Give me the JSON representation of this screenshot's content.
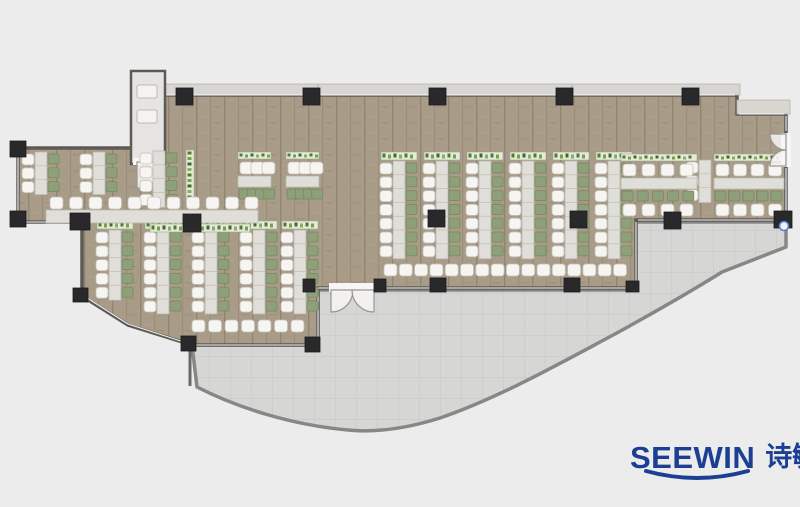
{
  "logo": {
    "brand": "SEEWIN",
    "cn": "诗敏",
    "color": "#1b3f92"
  },
  "palette": {
    "page_bg": "#ececec",
    "floor": "#a89b87",
    "floor_stroke": "#5d5a56",
    "terrace": "#d6d6d4",
    "terrace_stroke": "#878785",
    "band": "#d8d6d0",
    "band_stroke": "#b5b3ad",
    "vestibule": "#e5e4e2",
    "column": "#29292b",
    "desk": "#e0ded8",
    "desk_stroke": "#bab8b2",
    "chair": "#f6f5f2",
    "chair_stroke": "#c5c3be",
    "cabinet": "#8ea079",
    "cabinet_stroke": "#77875f",
    "planter": "#e7e9dd",
    "planter_stroke": "#9aa88a",
    "plant_greens": [
      "#4e7d2e",
      "#74a344",
      "#3f6b26",
      "#86b060"
    ],
    "door": "#f7f6f4",
    "door_stroke": "#989693",
    "glass_line": "#ffffff",
    "marker": "#4f7fd0"
  },
  "plan": {
    "floor_path": "M163,95 H737 V114 H786 V220 H636 V288 H318 V345 H192 L128,325 L82,296 V222 H18 V148 H133 V162 H163 Z",
    "terrace_path": "M318,290 H636 V222 H786 V247 L722,272 C690,292 655,312 615,334 C555,366 498,398 440,418 C408,428 378,433 348,430 C292,425 238,408 197,387 L192,345 H318 Z",
    "band": {
      "x": 163,
      "y": 84,
      "w": 577,
      "h": 11,
      "dividers": [
        318,
        572
      ],
      "step": {
        "x": 737,
        "y": 100,
        "w": 53,
        "h": 14
      }
    },
    "vestibule": {
      "x": 131,
      "y": 71,
      "w": 34,
      "h": 93,
      "fixtures": [
        [
          137,
          85,
          20,
          13
        ],
        [
          137,
          110,
          20,
          13
        ]
      ],
      "door_gap": [
        133,
        158,
        29,
        7
      ],
      "door_sector": "M137,162 L163,162 A26,26 0 0 1 137,188 Z"
    },
    "glass_lines": [
      [
        165,
        95,
        735,
        95
      ],
      [
        739,
        114,
        784,
        114
      ],
      [
        786,
        116,
        786,
        131
      ],
      [
        786,
        168,
        786,
        218
      ],
      [
        18,
        150,
        18,
        220
      ],
      [
        20,
        222,
        80,
        222
      ],
      [
        84,
        296,
        128,
        324
      ],
      [
        128,
        324,
        190,
        344
      ],
      [
        194,
        345,
        314,
        345
      ],
      [
        318,
        290,
        318,
        343
      ],
      [
        314,
        288,
        329,
        288
      ],
      [
        376,
        288,
        634,
        288
      ],
      [
        636,
        222,
        636,
        287
      ],
      [
        638,
        220,
        783,
        220
      ]
    ],
    "service_wall": [
      190,
      348,
      190,
      386
    ],
    "columns": [
      [
        176,
        88,
        17,
        17
      ],
      [
        303,
        88,
        17,
        17
      ],
      [
        429,
        88,
        17,
        17
      ],
      [
        556,
        88,
        17,
        17
      ],
      [
        682,
        88,
        17,
        17
      ],
      [
        10,
        141,
        16,
        16
      ],
      [
        10,
        211,
        16,
        16
      ],
      [
        70,
        213,
        20,
        17
      ],
      [
        183,
        214,
        18,
        18
      ],
      [
        73,
        288,
        15,
        14
      ],
      [
        181,
        336,
        15,
        15
      ],
      [
        305,
        337,
        15,
        15
      ],
      [
        303,
        279,
        12,
        13
      ],
      [
        374,
        279,
        12,
        13
      ],
      [
        430,
        278,
        16,
        14
      ],
      [
        564,
        278,
        16,
        14
      ],
      [
        626,
        281,
        13,
        11
      ],
      [
        664,
        212,
        17,
        17
      ],
      [
        774,
        211,
        18,
        17
      ],
      [
        428,
        210,
        17,
        17
      ],
      [
        570,
        211,
        17,
        17
      ]
    ],
    "doors": [
      {
        "gap": [
          329,
          283,
          47,
          9
        ],
        "sectors": [
          "M331,290 L331,312 A22,22 0 0 0 353,290 Z",
          "M374,290 L374,312 A22,22 0 0 1 352,290 Z"
        ]
      },
      {
        "gap": [
          781,
          133,
          10,
          34
        ],
        "sectors": [
          "M786,134 L770,134 A16,16 0 0 0 786,150 Z",
          "M786,166 L770,166 A16,16 0 0 1 786,150 Z"
        ]
      }
    ],
    "vrows": [
      {
        "x": 22,
        "y": 154,
        "n": 3
      },
      {
        "x": 80,
        "y": 154,
        "n": 3
      },
      {
        "x": 140,
        "y": 153,
        "n": 4
      },
      {
        "x": 380,
        "y": 163,
        "n": 7,
        "planter": true
      },
      {
        "x": 423,
        "y": 163,
        "n": 7,
        "planter": true
      },
      {
        "x": 466,
        "y": 163,
        "n": 7,
        "planter": true
      },
      {
        "x": 509,
        "y": 163,
        "n": 7,
        "planter": true
      },
      {
        "x": 552,
        "y": 163,
        "n": 7,
        "planter": true
      },
      {
        "x": 595,
        "y": 163,
        "n": 7,
        "planter": true
      },
      {
        "x": 96,
        "y": 232,
        "n": 5,
        "planter": true
      },
      {
        "x": 144,
        "y": 232,
        "n": 6,
        "planter": true
      },
      {
        "x": 192,
        "y": 232,
        "n": 6,
        "planter": true
      },
      {
        "x": 240,
        "y": 232,
        "n": 6,
        "planter": true
      },
      {
        "x": 281,
        "y": 232,
        "n": 6,
        "planter": true
      },
      {
        "x": 686,
        "y": 162,
        "n": 3,
        "nogreen": true
      }
    ],
    "vplanters": [
      [
        186,
        150,
        8,
        55
      ]
    ],
    "hclusters": [
      {
        "x": 238,
        "y": 152,
        "w": 33,
        "n": 3,
        "mirror": false
      },
      {
        "x": 286,
        "y": 152,
        "w": 33,
        "n": 3,
        "mirror": false
      },
      {
        "x": 621,
        "y": 154,
        "w": 76,
        "n": 4,
        "mirror": true
      },
      {
        "x": 714,
        "y": 154,
        "w": 70,
        "n": 4,
        "mirror": true
      }
    ],
    "hrow": {
      "desk": [
        46,
        210,
        212,
        13
      ],
      "chairs_y": 197,
      "chairs_x0": 50,
      "chairs_n": 11,
      "chairs_pitch": 19.5,
      "planter": [
        150,
        224,
        100,
        8
      ]
    },
    "bar_rows": [
      {
        "x": 384,
        "y": 264,
        "n": 16,
        "pitch": 15.3
      },
      {
        "x": 192,
        "y": 320,
        "n": 7,
        "pitch": 16.5
      }
    ],
    "marker": {
      "cx": 784,
      "cy": 226,
      "r": 4.5
    }
  }
}
